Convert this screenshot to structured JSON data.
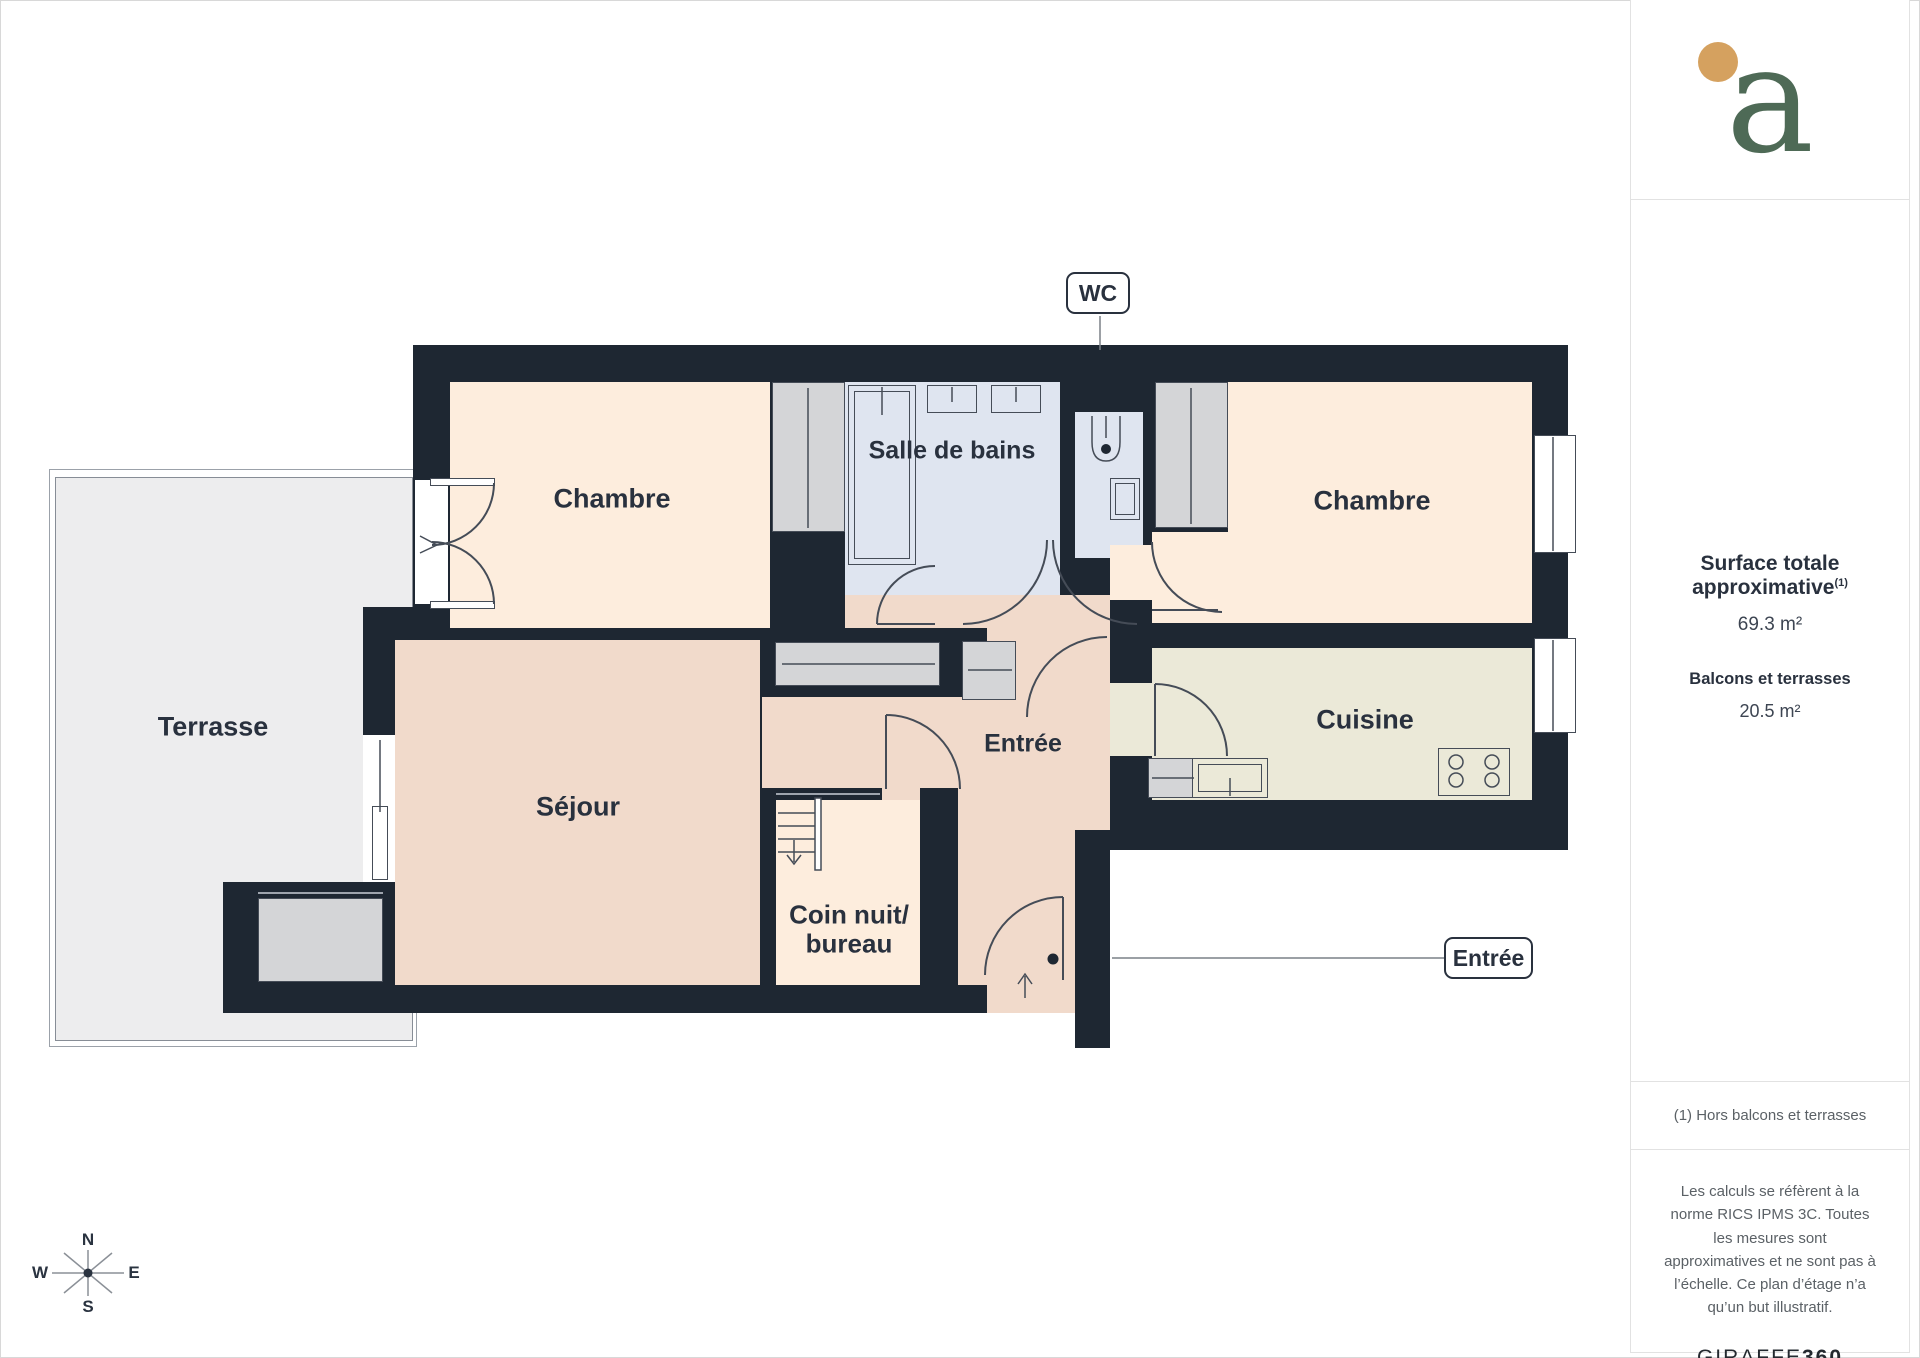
{
  "plan": {
    "rooms": {
      "terrasse": "Terrasse",
      "chambre_left": "Chambre",
      "salle_de_bains": "Salle de bains",
      "chambre_right": "Chambre",
      "sejour": "Séjour",
      "coin_nuit_line1": "Coin nuit/",
      "coin_nuit_line2": "bureau",
      "entree": "Entrée",
      "cuisine": "Cuisine"
    },
    "callouts": {
      "wc": "WC",
      "entree": "Entrée"
    },
    "compass": {
      "n": "N",
      "s": "S",
      "e": "E",
      "w": "W"
    }
  },
  "sidebar": {
    "logo_letter": "a",
    "surface_title": "Surface totale approximative",
    "surface_sup": "(1)",
    "surface_value": "69.3 m²",
    "balcony_title": "Balcons et terrasses",
    "balcony_value": "20.5 m²",
    "footnote": "(1) Hors balcons et terrasses",
    "legal": "Les calculs se réfèrent à la norme RICS IPMS 3C. Toutes les mesures sont approximatives et ne sont pas à l’échelle. Ce plan d’étage n’a qu’un but illustratif.",
    "brand_name": "GIRAFFE",
    "brand_suffix": "360"
  },
  "colors": {
    "wall": "#1e2732",
    "line": "#454c57",
    "peach": "#fdeddd",
    "pink": "#f1dacb",
    "blue": "#dfe5f0",
    "beige": "#ebe9d8",
    "terrace": "#ededee",
    "closet": "#d4d5d7",
    "label": "#29313e",
    "gray-text": "#5b6166",
    "leader": "#7a8087",
    "logo-green": "#4e6a56",
    "logo-orange": "#d5a15f",
    "divider": "#e2e2e2"
  }
}
